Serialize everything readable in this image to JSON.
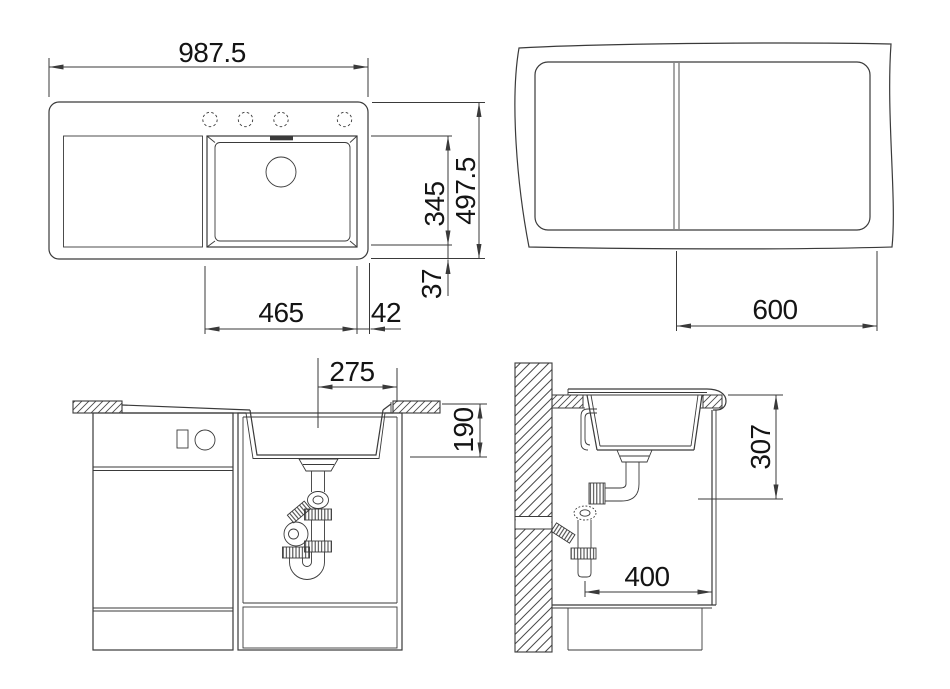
{
  "drawing": {
    "title": "sink-installation-drawing",
    "background": "#ffffff",
    "line_color": "#3a3a3a",
    "text_color": "#141414",
    "views": {
      "plan": {
        "dims": {
          "overall_width": "987.5",
          "overall_depth": "497.5",
          "bowl_length": "345",
          "bowl_to_edge": "37",
          "bowl_width": "465",
          "right_edge_offset": "42"
        }
      },
      "cutout": {
        "dims": {
          "min_cabinet_width": "600"
        }
      },
      "front_section": {
        "dims": {
          "drain_center_offset": "275",
          "bowl_depth": "190"
        }
      },
      "side_section": {
        "dims": {
          "worktop_to_clearance": "307",
          "min_cabinet_depth": "400"
        }
      }
    }
  }
}
